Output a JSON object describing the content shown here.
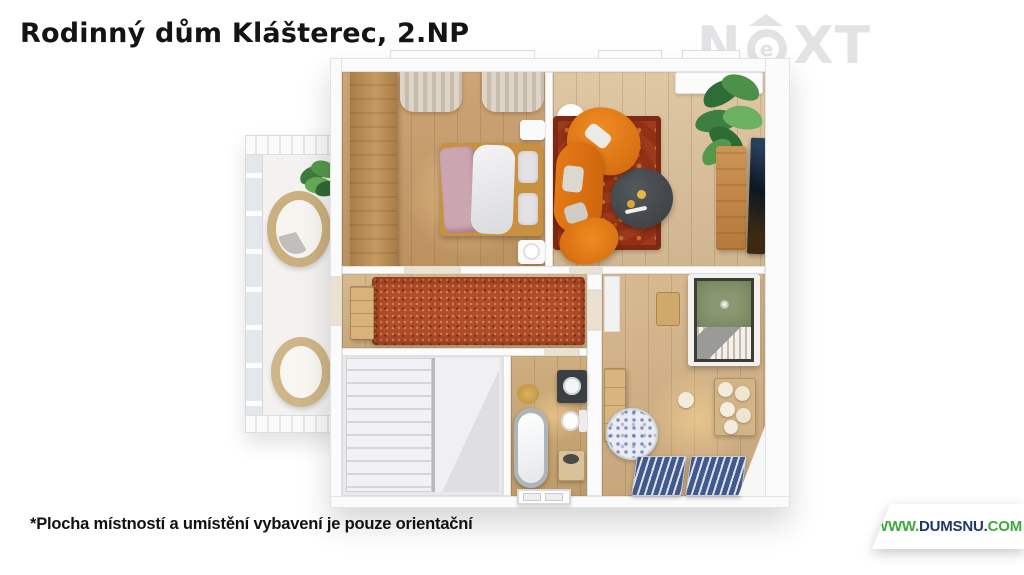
{
  "page": {
    "title": "Rodinný dům Klášterec, 2.NP",
    "disclaimer": "*Plocha místností a umístění vybavení je pouze orientační"
  },
  "brand_logo": {
    "letter_n": "N",
    "letter_e": "e",
    "letters_xt": "XT",
    "style": "letter e inside circle with roof (house pictogram)"
  },
  "footer_ribbon": {
    "www": "WWW.",
    "name": "DUMSNU.",
    "tld": "COM"
  },
  "theme_colors": {
    "logo_gray": "#e3e3e5",
    "ribbon_green": "#3ea93c",
    "ribbon_navy": "#1e3766",
    "sofa_orange": "#e0761c",
    "carpet_red": "#b04c28",
    "rug_red": "#9c3a1b",
    "bed_green": "#8c9a73",
    "mat_blue": "#41598c"
  },
  "floorplan": {
    "floor_label": "2.NP",
    "rooms": [
      {
        "name": "bedroom",
        "floor_color": "#c79a66",
        "furniture": [
          "wardrobe",
          "double-bed",
          "pink-blanket",
          "nightstands",
          "curtains"
        ]
      },
      {
        "name": "living-room",
        "floor_color": "#dcc199",
        "furniture": [
          "orange-curved-sofa",
          "oriental-rug",
          "round-coffee-table",
          "tv",
          "wood-sideboard",
          "large-plant",
          "white-cabinet",
          "round-side-table"
        ]
      },
      {
        "name": "balcony",
        "floor_color": "#f3f2f0",
        "furniture": [
          "wicker-chair",
          "wicker-chair",
          "plant",
          "glass-railing"
        ]
      },
      {
        "name": "hallway",
        "floor_color": "#d2b282",
        "furniture": [
          "red-shag-carpet",
          "small-cabinet"
        ]
      },
      {
        "name": "staircase",
        "floor_color": "#e9e9eb",
        "furniture": [
          "stairs",
          "railing"
        ]
      },
      {
        "name": "bathroom",
        "floor_color": "#c9a470",
        "furniture": [
          "freestanding-bathtub",
          "toilet",
          "vanity-with-sink",
          "round-rug",
          "laundry-box"
        ]
      },
      {
        "name": "kids-room",
        "floor_color": "#d3b184",
        "furniture": [
          "green-canopy-bed",
          "desk",
          "dresser",
          "round-patterned-rug",
          "toy-bench",
          "teddy-bears",
          "blue-striped-beds"
        ]
      }
    ]
  }
}
